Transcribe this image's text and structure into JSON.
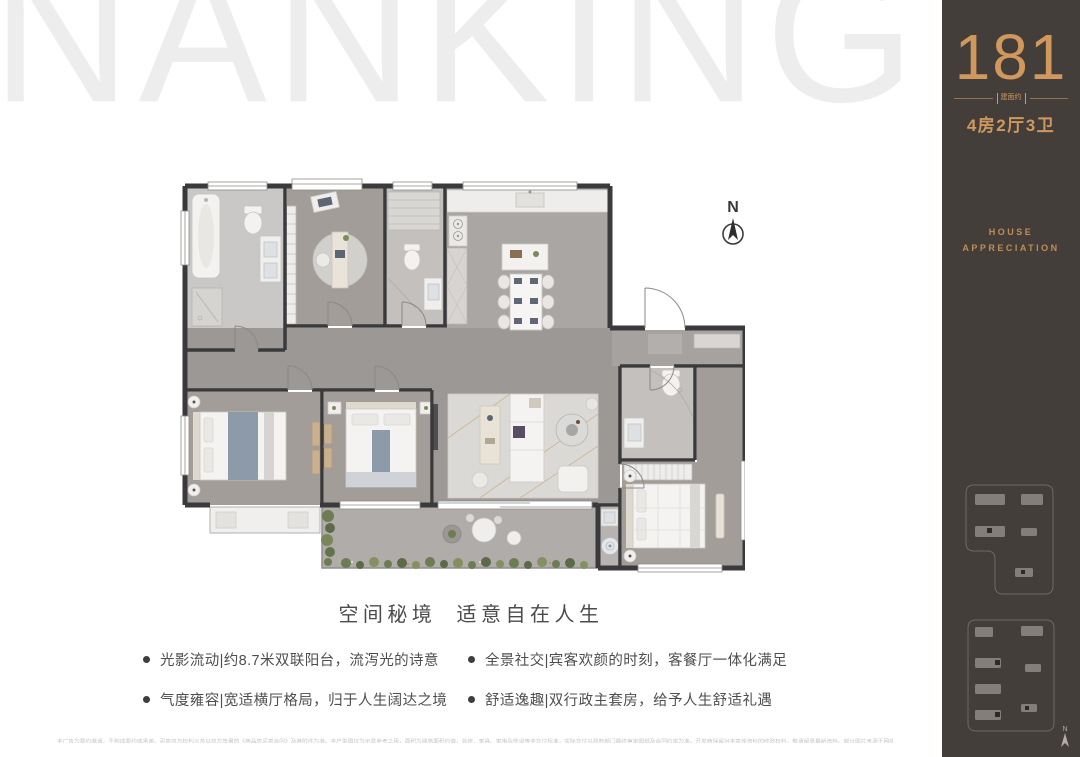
{
  "watermark": {
    "text": "NANKING",
    "color": "#ededed"
  },
  "sidebar": {
    "bg": "#433e3a",
    "accent": "#d0985c",
    "area_value": "181",
    "area_label": "建面约",
    "layout_label": "4房2厅3卫",
    "house_line1": "HOUSE",
    "house_line2": "APPRECIATION",
    "mini_compass_label": "N"
  },
  "floor_plan": {
    "compass_label": "N",
    "wall_color": "#3a3a3c"
  },
  "headline": {
    "text": "空间秘境  适意自在人生",
    "color": "#4b4b4b"
  },
  "features": [
    "光影流动|约8.7米双联阳台，流泻光的诗意",
    "气度雍容|宽适横厅格局，归于人生阔达之境",
    "全景社交|宾客欢颜的时刻，客餐厅一体化满足",
    "舒适逸趣|双行政主套房，给予人生舒适礼遇"
  ],
  "disclaimer": {
    "text": "本广告为要约邀请，不构成要约或承诺，买卖双方权利义务以双方签署的《商品房买卖合同》及其附件为准。本户型图仅为示意参考之用，面积为建筑面积约值，装修、家具、家电及陈设等非交付标准，实际交付以政府部门最终审定图纸及合同约定为准。开发商保留对本宣传资料的修改权利，敬请留意最新资料。部分图片来源于网络，如有侵权请联系删除。"
  }
}
